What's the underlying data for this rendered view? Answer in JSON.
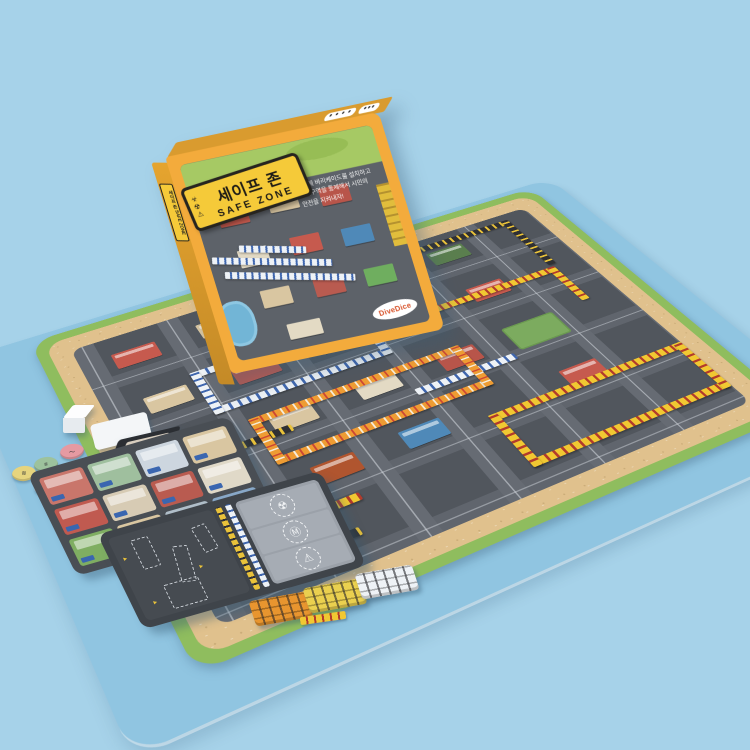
{
  "scene": {
    "background_color": "#a6d2e9",
    "description": "Product photo of the Korean board game 'Safe Zone' (세이프 존): standing game box, large city-road play mat covered with colored barricade-tape pieces, mission card tray, player board, black deck box, white die, round player tokens and three stacks of barricade sticks on a light blue surface"
  },
  "box": {
    "sign": {
      "title_ko": "세이프 존",
      "title_en": "SAFE ZONE",
      "icons": [
        {
          "name": "biohazard-icon",
          "glyph": "☣"
        },
        {
          "name": "radiation-icon",
          "glyph": "☢"
        },
        {
          "name": "warning-icon",
          "glyph": "⚠"
        }
      ]
    },
    "spine_text": "세이프 존 SAFE ZONE",
    "tagline_lines": [
      "도시에 바리케이드를 설치하고",
      "위험구역을 통제해서 시민의",
      "안전을 지켜내자!"
    ],
    "top_badges": [
      {
        "name": "info-badge",
        "glyph": "● ● ● ●"
      },
      {
        "name": "logo-badge",
        "glyph": "●●●"
      }
    ],
    "publisher_logo": "DiveDice",
    "colors": {
      "box_yellow": "#f3ab3c",
      "sign_yellow": "#f5ca39",
      "cover_green": "#a6c964",
      "cover_asphalt": "#5d6269"
    }
  },
  "mat": {
    "colors": {
      "grass_edge": "#8fbd5e",
      "sand_border": "#e0c18d",
      "asphalt": "#51565d",
      "road": "#666b73"
    },
    "tape_colors": {
      "yellow": "#f1c832",
      "white": "#eef2f6",
      "orange": "#ee9c33",
      "black": "#2f3034"
    }
  },
  "player_board": {
    "icons": [
      {
        "name": "radiation-icon",
        "glyph": "☢"
      },
      {
        "name": "mask-icon",
        "glyph": "Ⓜ"
      },
      {
        "name": "warning-icon",
        "glyph": "⚠"
      }
    ]
  },
  "components": {
    "die_color": "#f4f7fa",
    "tokens": [
      {
        "name": "token-pink",
        "color": "#e59aa2"
      },
      {
        "name": "token-green",
        "color": "#9dc29d"
      },
      {
        "name": "token-yellow",
        "color": "#e6d47e"
      },
      {
        "name": "token-white",
        "color": "#e3ebf1"
      }
    ],
    "stick_stacks": [
      {
        "name": "orange-sticks",
        "color": "#e8952f"
      },
      {
        "name": "yellow-sticks",
        "color": "#ead04f"
      },
      {
        "name": "white-sticks",
        "color": "#eef2f6"
      }
    ],
    "mission_cards_visible": 12,
    "mission_card_palette": [
      "#c9766b",
      "#9fbf9e",
      "#cdd6df",
      "#d9c6a1",
      "#c05a50",
      "#d7cbb4",
      "#b95b50",
      "#e0d9c8",
      "#7fae62",
      "#d9c6a1",
      "#b0bec9",
      "#88a8c8"
    ]
  }
}
